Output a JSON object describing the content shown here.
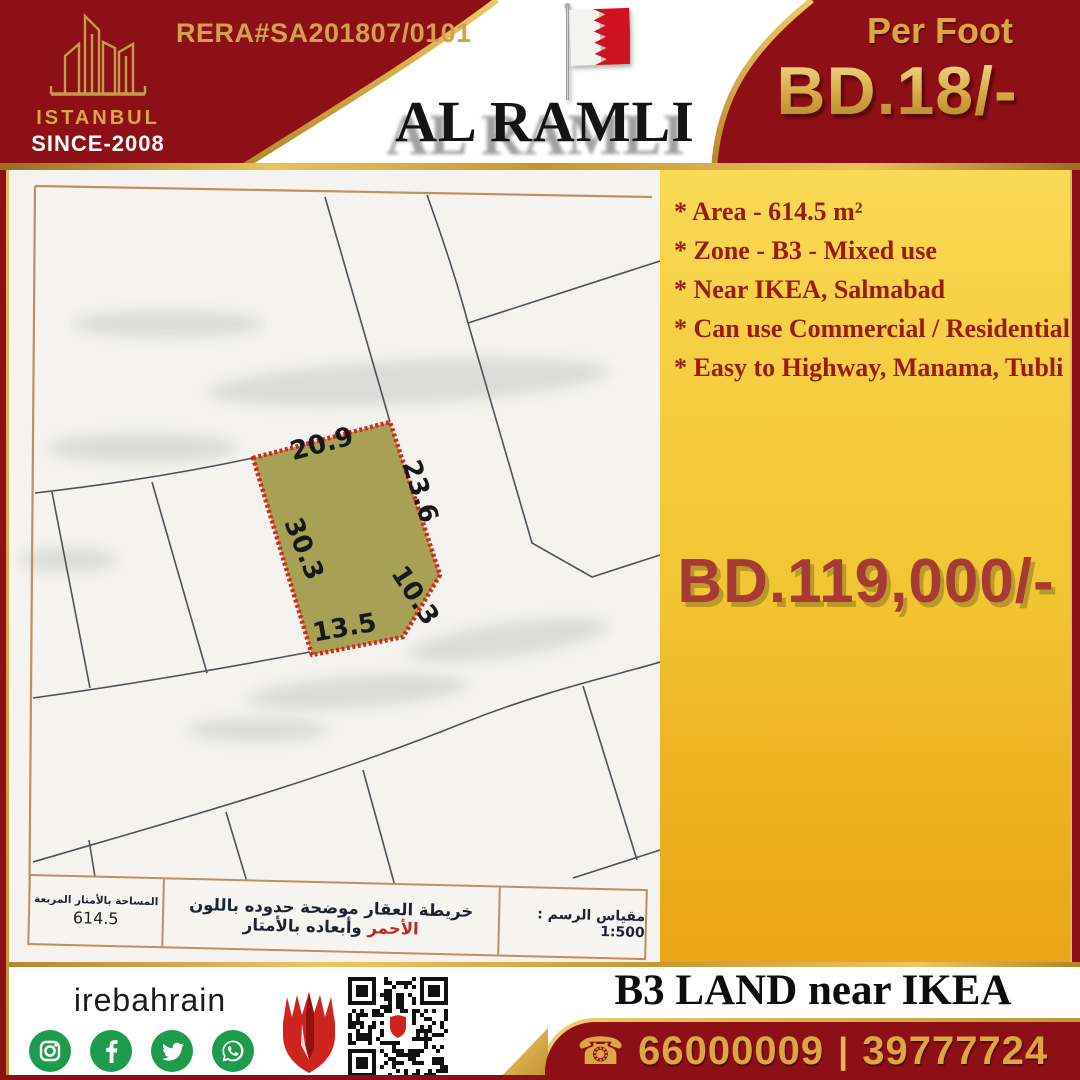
{
  "brand": {
    "name": "ISTANBUL",
    "since": "SINCE-2008",
    "rera": "RERA#SA201807/0101"
  },
  "header": {
    "title": "AL RAMLI",
    "per_foot_label": "Per Foot",
    "per_foot_price": "BD.18/-"
  },
  "listing": {
    "features": [
      "* Area - 614.5 m²",
      "* Zone - B3 - Mixed use",
      "* Near IKEA, Salmabad",
      "* Can use Commercial / Residential",
      "* Easy to Highway, Manama, Tubli"
    ],
    "price": "BD.119,000/-"
  },
  "map": {
    "dimensions": {
      "top": "20.9",
      "right": "23.6",
      "left": "30.3",
      "corner": "10.3",
      "bottom": "13.5"
    },
    "table": {
      "area_label": "المساحة بالأمتار المربعة",
      "area_value": "614.5",
      "desc_pre": "خريطة العقار موضحة حدوده باللون",
      "desc_red": "الأحمر",
      "desc_post": "وأبعاده بالأمتار",
      "scale": "مقياس الرسم : 1:500"
    }
  },
  "footer": {
    "social_handle": "irebahrain",
    "icons": [
      "instagram-icon",
      "facebook-icon",
      "twitter-icon",
      "whatsapp-icon"
    ],
    "tagline": "B3 LAND near IKEA",
    "phone_glyph": "☎",
    "phone1": "66000009",
    "separator": "|",
    "phone2": "39777724"
  },
  "colors": {
    "header_red": "#8c1016",
    "gold": "#d2a149",
    "yellow_top": "#f8d84f",
    "yellow_bottom": "#e9a515",
    "feature_red": "#9c1b10",
    "price_red": "#a43c34",
    "plot_fill": "#a7a155",
    "plot_border": "#cf2b1f",
    "social_green": "#1f9b4d"
  }
}
